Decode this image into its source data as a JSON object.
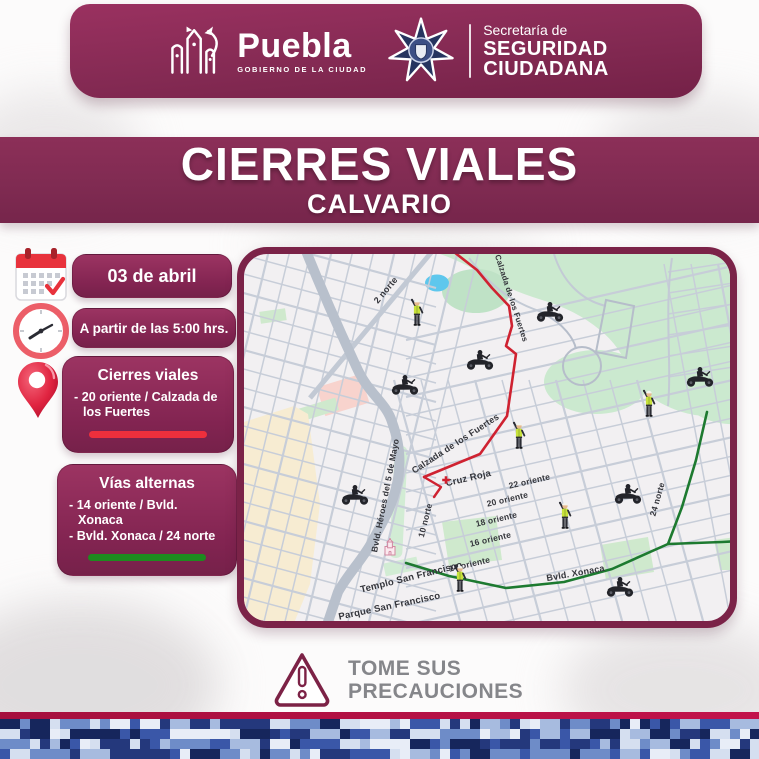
{
  "header": {
    "puebla_logo_text": "Puebla",
    "puebla_logo_subtext": "GOBIERNO DE LA CIUDAD",
    "ssc_line1": "Secretaría de",
    "ssc_line2": "SEGURIDAD",
    "ssc_line3": "CIUDADANA"
  },
  "title": {
    "main": "CIERRES VIALES",
    "sub": "CALVARIO"
  },
  "sidebar": {
    "date_label": "03 de abril",
    "time_label": "A partir de las 5:00 hrs.",
    "closures": {
      "title": "Cierres viales",
      "item1": "- 20 oriente / Calzada de los Fuertes",
      "line_color": "#ee2f3c"
    },
    "alternates": {
      "title": "Vías alternas",
      "item1": "- 14 oriente / Bvld. Xonaca",
      "item2": "- Bvld. Xonaca / 24 norte",
      "line_color": "#1e8a1f"
    }
  },
  "map": {
    "labels": [
      {
        "t": "2 norte",
        "x": 144,
        "y": 38,
        "r": -50,
        "s": 9
      },
      {
        "t": "Calzada de los Fuertes",
        "x": 265,
        "y": 45,
        "r": 72,
        "s": 8
      },
      {
        "t": "Calzada de los Fuertes",
        "x": 213,
        "y": 192,
        "r": -33,
        "s": 9
      },
      {
        "t": "Cruz Roja",
        "x": 225,
        "y": 227,
        "r": -13,
        "s": 9.5
      },
      {
        "t": "22 oriente",
        "x": 286,
        "y": 230,
        "r": -13,
        "s": 8.5
      },
      {
        "t": "20 oriente",
        "x": 264,
        "y": 248,
        "r": -13,
        "s": 8.5
      },
      {
        "t": "18 oriente",
        "x": 253,
        "y": 268,
        "r": -13,
        "s": 8.5
      },
      {
        "t": "16 oriente",
        "x": 247,
        "y": 288,
        "r": -13,
        "s": 8.5
      },
      {
        "t": "14 oriente",
        "x": 226,
        "y": 313,
        "r": -13,
        "s": 8.5
      },
      {
        "t": "10 norte",
        "x": 184,
        "y": 267,
        "r": -76,
        "s": 8.5
      },
      {
        "t": "Bvld. Héroes del 5 de Mayo",
        "x": 144,
        "y": 242,
        "r": -79,
        "s": 8.5
      },
      {
        "t": "Templo San Francisco",
        "x": 168,
        "y": 326,
        "r": -14,
        "s": 9.5
      },
      {
        "t": "Parque San Francisco",
        "x": 146,
        "y": 355,
        "r": -12,
        "s": 9.5
      },
      {
        "t": "Bvld.  Xonaca",
        "x": 332,
        "y": 322,
        "r": -10,
        "s": 9
      },
      {
        "t": "24 norte",
        "x": 416,
        "y": 246,
        "r": -74,
        "s": 8.5
      }
    ],
    "closure_route": {
      "color": "#cf2231",
      "points": [
        [
          210,
          -2
        ],
        [
          233,
          16
        ],
        [
          248,
          34
        ],
        [
          265,
          52
        ],
        [
          268,
          72
        ],
        [
          262,
          92
        ],
        [
          272,
          100
        ],
        [
          268,
          128
        ],
        [
          263,
          162
        ],
        [
          236,
          200
        ],
        [
          180,
          223
        ]
      ],
      "fork": [
        [
          180,
          223
        ],
        [
          197,
          233
        ],
        [
          190,
          243
        ]
      ]
    },
    "alternate_routes": {
      "color": "#1d7a30",
      "route_a": [
        [
          162,
          309
        ],
        [
          205,
          322
        ],
        [
          262,
          334
        ],
        [
          320,
          328
        ],
        [
          368,
          315
        ],
        [
          424,
          290
        ],
        [
          478,
          288
        ],
        [
          498,
          287
        ]
      ],
      "route_b": [
        [
          463,
          158
        ],
        [
          452,
          206
        ],
        [
          438,
          253
        ],
        [
          424,
          290
        ]
      ]
    },
    "officers": [
      [
        173,
        60
      ],
      [
        275,
        183
      ],
      [
        321,
        263
      ],
      [
        405,
        151
      ],
      [
        216,
        326
      ]
    ],
    "motorcycles": [
      [
        161,
        131
      ],
      [
        236,
        106
      ],
      [
        306,
        58
      ],
      [
        384,
        240
      ],
      [
        456,
        123
      ],
      [
        376,
        333
      ],
      [
        111,
        241
      ]
    ],
    "cruz_roja_cross": [
      202,
      226
    ],
    "church": [
      146,
      300
    ]
  },
  "footer": {
    "warning_line1": "TOME SUS",
    "warning_line2": "PRECAUCIONES"
  },
  "theme": {
    "maroon": "#84294f",
    "map_border": "#7b2348",
    "camo_palette": [
      "#16265c",
      "#24387c",
      "#3a57a8",
      "#6e8cc8",
      "#a7bbdf",
      "#d5dff0",
      "#e8edf7"
    ]
  }
}
